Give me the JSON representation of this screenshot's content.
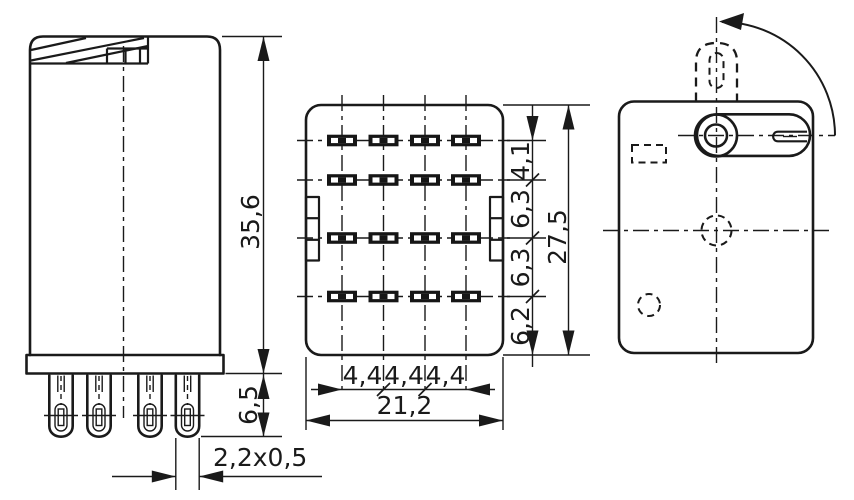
{
  "drawing": {
    "line_color": "#1a1a1a",
    "background": "#ffffff",
    "front_view": {
      "height": "35,6",
      "pin_length": "6,5",
      "pin_cross_section": "2,2x0,5"
    },
    "bottom_view": {
      "pin_pitch": [
        "4,4",
        "4,4",
        "4,4"
      ],
      "overall_width": "21,2",
      "row_offsets": [
        "4,1",
        "6,3",
        "6,3",
        "6,2"
      ],
      "overall_height": "27,5"
    }
  }
}
